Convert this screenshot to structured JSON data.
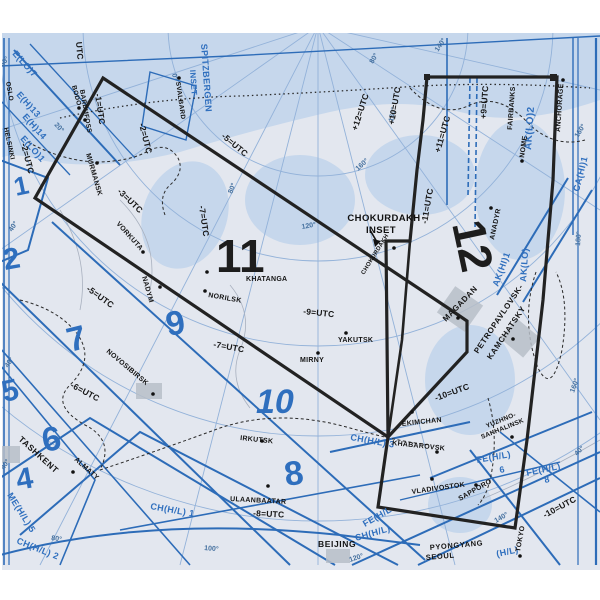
{
  "page": {
    "title": "Enroute Chart Index Map — Panels 11 / 12 (Russia, Alaska, Far East)"
  },
  "colors": {
    "sea": "#c6d7ec",
    "land": "#e3e7ef",
    "boundary_blue": "#2d6cb8",
    "graticule_blue": "#93b2d9",
    "series_blue": "#2f6fbe",
    "outline_black": "#222222",
    "gray_box": "#b8bec8"
  },
  "map": {
    "inset": {
      "line1": "CHOKURDAKH",
      "line2": "INSET"
    },
    "panel_numbers": [
      {
        "text": "1",
        "x": 16,
        "y": 196,
        "rot": -12,
        "size": 26
      },
      {
        "text": "2",
        "x": 5,
        "y": 270,
        "rot": -10,
        "size": 30
      },
      {
        "text": "5",
        "x": 4,
        "y": 402,
        "rot": -12,
        "size": 30
      },
      {
        "text": "7",
        "x": 70,
        "y": 352,
        "rot": -14,
        "size": 34
      },
      {
        "text": "9",
        "x": 168,
        "y": 336,
        "rot": -10,
        "size": 34
      },
      {
        "text": "6",
        "x": 44,
        "y": 452,
        "rot": -10,
        "size": 34
      },
      {
        "text": "4",
        "x": 18,
        "y": 490,
        "rot": -10,
        "size": 30
      },
      {
        "text": "10",
        "x": 256,
        "y": 413,
        "rot": 0,
        "size": 34,
        "cls": "ital"
      },
      {
        "text": "8",
        "x": 286,
        "y": 486,
        "rot": -8,
        "size": 34
      },
      {
        "text": "11",
        "x": 216,
        "y": 272,
        "rot": 0,
        "size": 46,
        "cls": "blk"
      },
      {
        "text": "12",
        "x": 452,
        "y": 224,
        "rot": 78,
        "size": 46,
        "cls": "blk"
      }
    ],
    "cities": [
      {
        "text": "OSLO",
        "x": 6,
        "y": 82,
        "rot": 80,
        "size": 6.5
      },
      {
        "text": "HELSINKI",
        "x": 4,
        "y": 128,
        "rot": 78,
        "size": 6.5
      },
      {
        "text": "BODO",
        "x": 72,
        "y": 86,
        "rot": 75,
        "size": 6.5,
        "dot": [
          79,
          108
        ]
      },
      {
        "text": "BARDUFOSS",
        "x": 80,
        "y": 90,
        "rot": 80,
        "size": 6.5,
        "dot": [
          85,
          120
        ]
      },
      {
        "text": "SVALBARD",
        "x": 176,
        "y": 82,
        "rot": 82,
        "size": 6.5,
        "dot": [
          179,
          78
        ]
      },
      {
        "text": "MURMANSK",
        "x": 86,
        "y": 154,
        "rot": 74,
        "size": 7,
        "dot": [
          97,
          163
        ]
      },
      {
        "text": "VORKUTA",
        "x": 116,
        "y": 224,
        "rot": 48,
        "size": 7,
        "dot": [
          143,
          252
        ]
      },
      {
        "text": "NADYM",
        "x": 142,
        "y": 277,
        "rot": 74,
        "size": 7,
        "dot": [
          160,
          287
        ]
      },
      {
        "text": "NORILSK",
        "x": 208,
        "y": 297,
        "rot": 10,
        "size": 7,
        "dot": [
          205,
          291
        ]
      },
      {
        "text": "KHATANGA",
        "x": 246,
        "y": 281,
        "rot": 0,
        "size": 7,
        "dot": [
          207,
          272
        ]
      },
      {
        "text": "CHOKURDAKH",
        "x": 364,
        "y": 275,
        "rot": -58,
        "size": 6,
        "dot": [
          394,
          248
        ]
      },
      {
        "text": "ANADYR",
        "x": 494,
        "y": 240,
        "rot": -78,
        "size": 7,
        "dot": [
          491,
          208
        ]
      },
      {
        "text": "NOME",
        "x": 524,
        "y": 158,
        "rot": -82,
        "size": 7,
        "dot": [
          522,
          161
        ]
      },
      {
        "text": "FAIRBANKS",
        "x": 512,
        "y": 130,
        "rot": -86,
        "size": 7
      },
      {
        "text": "ANCHORAGE",
        "x": 560,
        "y": 132,
        "rot": -86,
        "size": 7,
        "dot": [
          563,
          80
        ]
      },
      {
        "text": "YAKUTSK",
        "x": 338,
        "y": 342,
        "rot": 0,
        "size": 7,
        "dot": [
          346,
          333
        ]
      },
      {
        "text": "MIRNY",
        "x": 300,
        "y": 362,
        "rot": 0,
        "size": 7,
        "dot": [
          318,
          353
        ]
      },
      {
        "text": "NOVOSIBIRSK",
        "x": 106,
        "y": 352,
        "rot": 40,
        "size": 7,
        "dot": [
          153,
          394
        ]
      },
      {
        "text": "IRKUTSK",
        "x": 240,
        "y": 440,
        "rot": 6,
        "size": 7,
        "dot": [
          262,
          441
        ]
      },
      {
        "text": "ULAANBAATAR",
        "x": 230,
        "y": 501,
        "rot": 3,
        "size": 7,
        "dot": [
          268,
          486
        ]
      },
      {
        "text": "MAGADAN",
        "x": 446,
        "y": 322,
        "rot": -46,
        "size": 8,
        "cls": "big",
        "dot": [
          458,
          318
        ]
      },
      {
        "text": "PETROPAVLOVSK-",
        "x": 478,
        "y": 354,
        "rot": -56,
        "size": 8,
        "cls": "big"
      },
      {
        "text": "KAMCHATSKY",
        "x": 491,
        "y": 360,
        "rot": -56,
        "size": 8,
        "cls": "big",
        "dot": [
          513,
          339
        ]
      },
      {
        "text": "EKIMCHAN",
        "x": 402,
        "y": 426,
        "rot": -6,
        "size": 7,
        "dot": [
          412,
          412
        ]
      },
      {
        "text": "KHABAROVSK",
        "x": 392,
        "y": 445,
        "rot": 6,
        "size": 7,
        "dot": [
          437,
          452
        ]
      },
      {
        "text": "YUZHNO-",
        "x": 487,
        "y": 428,
        "rot": -22,
        "size": 6.5
      },
      {
        "text": "SAKHALINSK",
        "x": 482,
        "y": 439,
        "rot": -22,
        "size": 6.5,
        "dot": [
          512,
          437
        ]
      },
      {
        "text": "VLADIVOSTOK",
        "x": 412,
        "y": 494,
        "rot": -8,
        "size": 7,
        "dot": [
          432,
          479
        ]
      },
      {
        "text": "SAPPORO",
        "x": 460,
        "y": 501,
        "rot": -30,
        "size": 7,
        "dot": [
          476,
          485
        ]
      },
      {
        "text": "TOKYO",
        "x": 520,
        "y": 552,
        "rot": -80,
        "size": 7,
        "dot": [
          520,
          556
        ]
      },
      {
        "text": "BEIJING",
        "x": 318,
        "y": 547,
        "rot": 0,
        "size": 8.5,
        "cls": "big"
      },
      {
        "text": "PYONGYANG",
        "x": 430,
        "y": 550,
        "rot": -5,
        "size": 7.5,
        "cls": "big"
      },
      {
        "text": "SEOUL",
        "x": 426,
        "y": 560,
        "rot": -5,
        "size": 7.5,
        "cls": "big"
      },
      {
        "text": "TASHKENT",
        "x": 18,
        "y": 440,
        "rot": 42,
        "size": 8.5,
        "cls": "big"
      },
      {
        "text": "ALMATY",
        "x": 74,
        "y": 460,
        "rot": 42,
        "size": 7,
        "dot": [
          73,
          472
        ]
      }
    ],
    "utc_labels": [
      {
        "text": "UTC",
        "x": 76,
        "y": 42,
        "rot": 85
      },
      {
        "text": "-1=UTC",
        "x": 95,
        "y": 94,
        "rot": 82
      },
      {
        "text": "-2=UTC",
        "x": 139,
        "y": 124,
        "rot": 76
      },
      {
        "text": "-2=UTC",
        "x": 21,
        "y": 144,
        "rot": 76
      },
      {
        "text": "-3=UTC",
        "x": 117,
        "y": 192,
        "rot": 44
      },
      {
        "text": "-5=UTC",
        "x": 221,
        "y": 137,
        "rot": 40
      },
      {
        "text": "-7=UTC",
        "x": 199,
        "y": 206,
        "rot": 82
      },
      {
        "text": "-5=UTC",
        "x": 86,
        "y": 290,
        "rot": 36
      },
      {
        "text": "-6=UTC",
        "x": 70,
        "y": 387,
        "rot": 28
      },
      {
        "text": "-7=UTC",
        "x": 213,
        "y": 347,
        "rot": 10
      },
      {
        "text": "-9=UTC",
        "x": 303,
        "y": 314,
        "rot": 6
      },
      {
        "text": "-8=UTC",
        "x": 253,
        "y": 516,
        "rot": 3
      },
      {
        "text": "-10=UTC",
        "x": 436,
        "y": 401,
        "rot": -20
      },
      {
        "text": "-10=UTC",
        "x": 545,
        "y": 518,
        "rot": -28
      },
      {
        "text": "-11=UTC",
        "x": 427,
        "y": 224,
        "rot": -80
      },
      {
        "text": "+11=UTC",
        "x": 440,
        "y": 153,
        "rot": -74
      },
      {
        "text": "+10=UTC",
        "x": 394,
        "y": 125,
        "rot": -80
      },
      {
        "text": "+12=UTC",
        "x": 357,
        "y": 131,
        "rot": -72
      },
      {
        "text": "+9=UTC",
        "x": 486,
        "y": 119,
        "rot": -86
      }
    ],
    "chart_series_labels": [
      {
        "text": "E(LO)7",
        "x": 12,
        "y": 54,
        "rot": 48
      },
      {
        "text": "E(H)13",
        "x": 16,
        "y": 95,
        "rot": 48
      },
      {
        "text": "E(H)14",
        "x": 22,
        "y": 117,
        "rot": 48
      },
      {
        "text": "E(LO)1",
        "x": 20,
        "y": 139,
        "rot": 48
      },
      {
        "text": "SPITZBERGEN",
        "x": 201,
        "y": 44,
        "rot": 86,
        "size": 9
      },
      {
        "text": "INSET",
        "x": 190,
        "y": 70,
        "rot": 86,
        "size": 8
      },
      {
        "text": "AK(LO)2",
        "x": 531,
        "y": 150,
        "rot": -86,
        "size": 10
      },
      {
        "text": "AK(LO)",
        "x": 526,
        "y": 282,
        "rot": -86
      },
      {
        "text": "AK(HI)1",
        "x": 498,
        "y": 287,
        "rot": -70
      },
      {
        "text": "CA(HI)1",
        "x": 579,
        "y": 192,
        "rot": -76
      },
      {
        "text": "CH(H/L) 1",
        "x": 150,
        "y": 509,
        "rot": 10
      },
      {
        "text": "CH(H/L) 2",
        "x": 16,
        "y": 543,
        "rot": 22
      },
      {
        "text": "CH(H/L) 3",
        "x": 350,
        "y": 440,
        "rot": 10
      },
      {
        "text": "CH(H/L)",
        "x": 356,
        "y": 541,
        "rot": -16
      },
      {
        "text": "FE(H/L)",
        "x": 477,
        "y": 463,
        "rot": -10
      },
      {
        "text": "6",
        "x": 500,
        "y": 473,
        "rot": -10
      },
      {
        "text": "FE(H/L)",
        "x": 527,
        "y": 476,
        "rot": -12
      },
      {
        "text": "8",
        "x": 545,
        "y": 483,
        "rot": -12
      },
      {
        "text": "FE(H/L",
        "x": 365,
        "y": 527,
        "rot": -30
      },
      {
        "text": "(H/L)",
        "x": 497,
        "y": 557,
        "rot": -12
      },
      {
        "text": "ME(H/L) 5",
        "x": 7,
        "y": 495,
        "rot": 58
      }
    ],
    "graticule_labels": [
      {
        "text": "60°",
        "x": 3,
        "y": 67,
        "rot": -52
      },
      {
        "text": "0°",
        "x": 172,
        "y": 74,
        "rot": 78
      },
      {
        "text": "20°",
        "x": 54,
        "y": 125,
        "rot": 48
      },
      {
        "text": "40°",
        "x": 12,
        "y": 232,
        "rot": -56
      },
      {
        "text": "40°",
        "x": 8,
        "y": 368,
        "rot": -56
      },
      {
        "text": "40°",
        "x": 4,
        "y": 470,
        "rot": -56
      },
      {
        "text": "80°",
        "x": 232,
        "y": 194,
        "rot": -68
      },
      {
        "text": "80°",
        "x": 373,
        "y": 64,
        "rot": -60
      },
      {
        "text": "80°",
        "x": 51,
        "y": 540,
        "rot": 8
      },
      {
        "text": "100°",
        "x": 204,
        "y": 550,
        "rot": 5
      },
      {
        "text": "120°",
        "x": 302,
        "y": 229,
        "rot": -10
      },
      {
        "text": "120°",
        "x": 350,
        "y": 562,
        "rot": -18
      },
      {
        "text": "140°",
        "x": 438,
        "y": 52,
        "rot": -56
      },
      {
        "text": "140°",
        "x": 496,
        "y": 523,
        "rot": -30
      },
      {
        "text": "160°",
        "x": 358,
        "y": 171,
        "rot": -42
      },
      {
        "text": "160°",
        "x": 393,
        "y": 122,
        "rot": -78
      },
      {
        "text": "160°",
        "x": 578,
        "y": 138,
        "rot": -58
      },
      {
        "text": "160°",
        "x": 574,
        "y": 393,
        "rot": -70
      },
      {
        "text": "180°",
        "x": 580,
        "y": 246,
        "rot": -86
      },
      {
        "text": "40°",
        "x": 577,
        "y": 456,
        "rot": -45
      }
    ]
  }
}
